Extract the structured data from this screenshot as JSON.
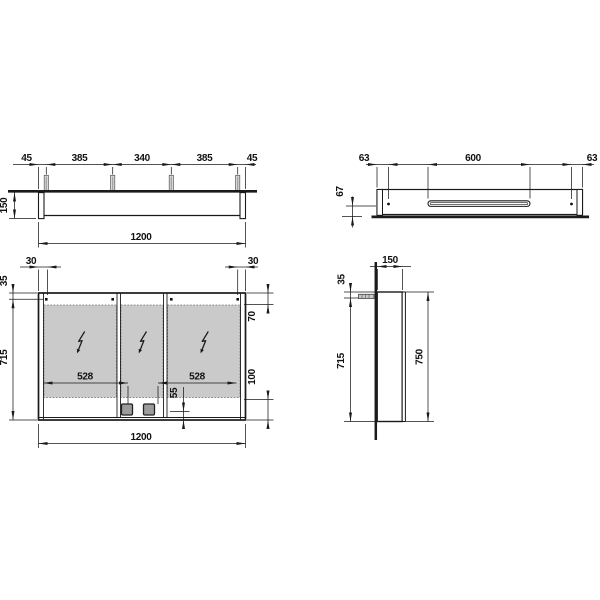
{
  "drawing": {
    "title": "mirror-cabinet-technical-drawing",
    "colors": {
      "line": "#1a1a1a",
      "mirror_glass": "#cacaca",
      "socket": "#9c9c9c",
      "mounting_pin": "#d9d9d9",
      "background": "#ffffff"
    },
    "views": {
      "top": {
        "name": "top-view",
        "dims": {
          "d45_left": "45",
          "d385_left": "385",
          "d340": "340",
          "d385_right": "385",
          "d45_right": "45",
          "d150": "150",
          "d1200": "1200"
        }
      },
      "underside": {
        "name": "underside-view",
        "dims": {
          "d63_left": "63",
          "d600": "600",
          "d63_right": "63",
          "d67": "67"
        }
      },
      "front": {
        "name": "front-view",
        "dims": {
          "d30_left": "30",
          "d30_right": "30",
          "d35": "35",
          "d715": "715",
          "d70": "70",
          "d100": "100",
          "d528_left": "528",
          "d528_right": "528",
          "d55": "55",
          "d1200": "1200"
        }
      },
      "side": {
        "name": "side-view",
        "dims": {
          "d150": "150",
          "d35": "35",
          "d715": "715",
          "d750": "750"
        }
      }
    }
  }
}
